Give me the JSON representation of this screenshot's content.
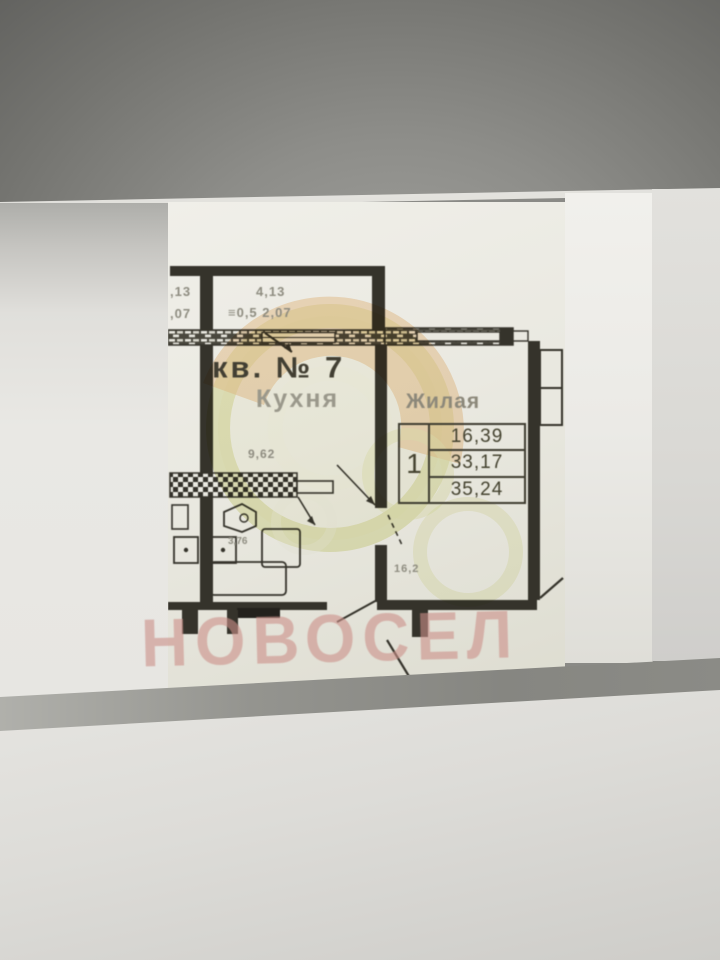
{
  "plan": {
    "apartment_title": "кв. № 7",
    "kitchen": {
      "label": "Кухня",
      "area": "9,62",
      "fixture_dim": "3,76"
    },
    "living": {
      "label": "Жилая",
      "dim": "16,2"
    },
    "balcony": {
      "dim_length": "4,13",
      "dim_depth": "≡0,5 2,07",
      "cut_dim_length": ",13",
      "cut_dim_depth": ",07"
    },
    "area_table": {
      "rooms_count": "1",
      "living_area": "16,39",
      "apartment_area": "33,17",
      "total_area": "35,24"
    }
  },
  "watermarks": {
    "agency": "НОВОСЕЛ"
  },
  "colors": {
    "wall": "#35332b",
    "paper": "#eceae3",
    "watermark_yellow": "#dde28f",
    "watermark_orange": "#f0c08c",
    "novosel_pink": "#cb9088"
  }
}
